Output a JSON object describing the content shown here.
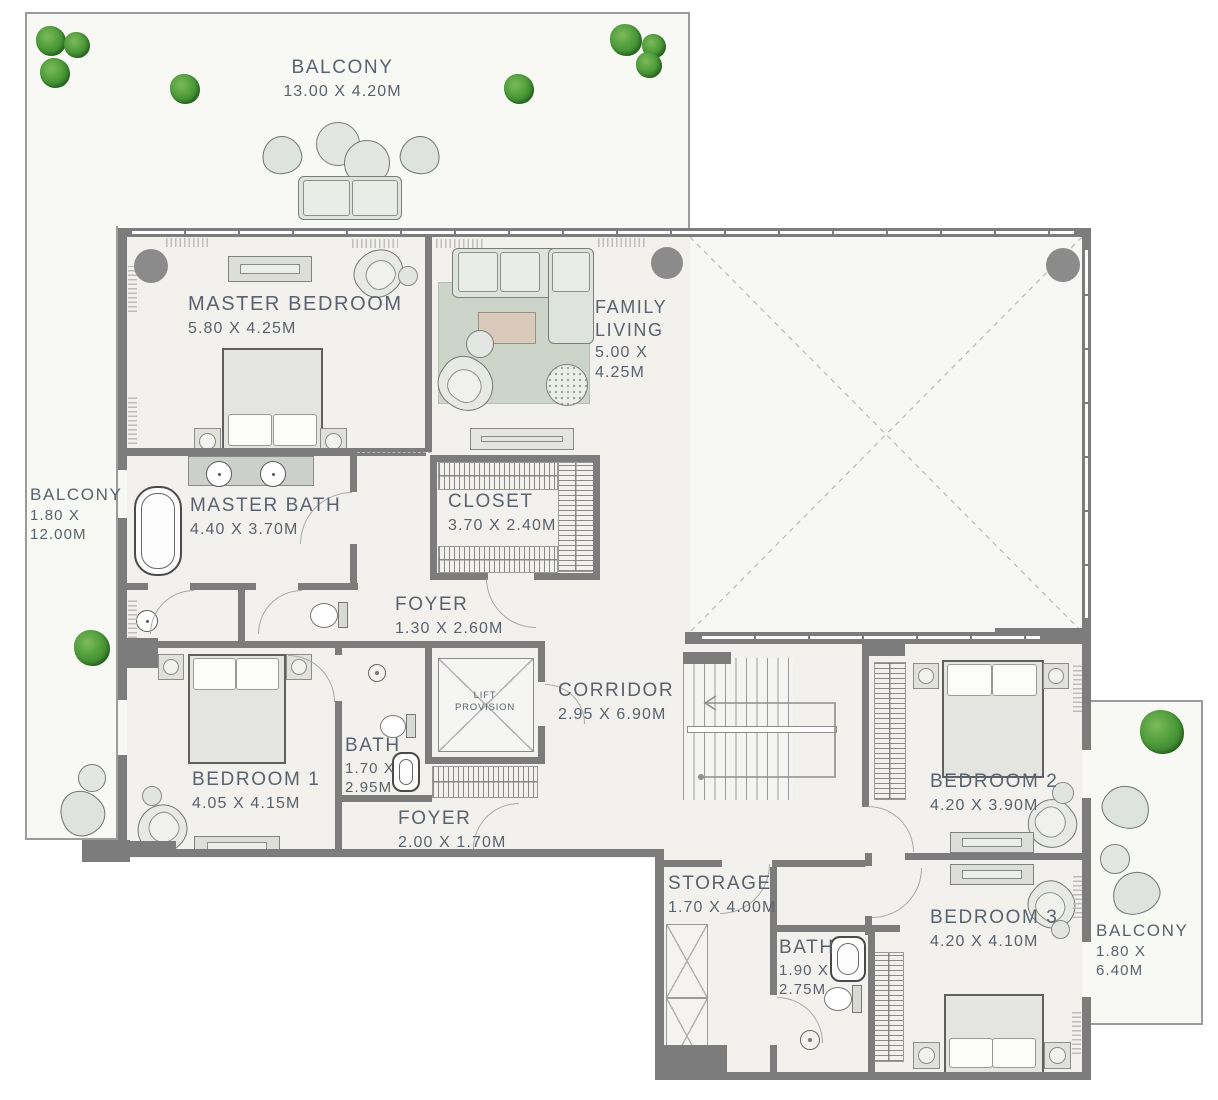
{
  "plan": {
    "wall_color": "#7c7c7c",
    "label_color": "#59636d",
    "plant_color": "#4f9c3b"
  },
  "rooms": [
    {
      "id": "balcony-top",
      "label": "BALCONY",
      "dims": "13.00 X 4.20M"
    },
    {
      "id": "balcony-left",
      "label": "BALCONY",
      "dims": "1.80 X 12.00M"
    },
    {
      "id": "master-bedroom",
      "label": "MASTER BEDROOM",
      "dims": "5.80 X 4.25M"
    },
    {
      "id": "family-living",
      "label": "FAMILY LIVING",
      "dims": "5.00 X 4.25M"
    },
    {
      "id": "master-bath",
      "label": "MASTER BATH",
      "dims": "4.40 X 3.70M"
    },
    {
      "id": "closet",
      "label": "CLOSET",
      "dims": "3.70 X 2.40M"
    },
    {
      "id": "foyer-upper",
      "label": "FOYER",
      "dims": "1.30 X 2.60M"
    },
    {
      "id": "corridor",
      "label": "CORRIDOR",
      "dims": "2.95 X 6.90M"
    },
    {
      "id": "bath-1",
      "label": "BATH",
      "dims": "1.70 X 2.95M"
    },
    {
      "id": "bedroom-1",
      "label": "BEDROOM 1",
      "dims": "4.05 X 4.15M"
    },
    {
      "id": "foyer-lower",
      "label": "FOYER",
      "dims": "2.00 X 1.70M"
    },
    {
      "id": "storage",
      "label": "STORAGE",
      "dims": "1.70 X 4.00M"
    },
    {
      "id": "bedroom-2",
      "label": "BEDROOM 2",
      "dims": "4.20 X 3.90M"
    },
    {
      "id": "bath-2",
      "label": "BATH",
      "dims": "1.90 X 2.75M"
    },
    {
      "id": "bedroom-3",
      "label": "BEDROOM 3",
      "dims": "4.20 X 4.10M"
    },
    {
      "id": "balcony-right",
      "label": "BALCONY",
      "dims": "1.80 X 6.40M"
    }
  ],
  "lift": {
    "line1": "LIFT",
    "line2": "PROVISION"
  }
}
